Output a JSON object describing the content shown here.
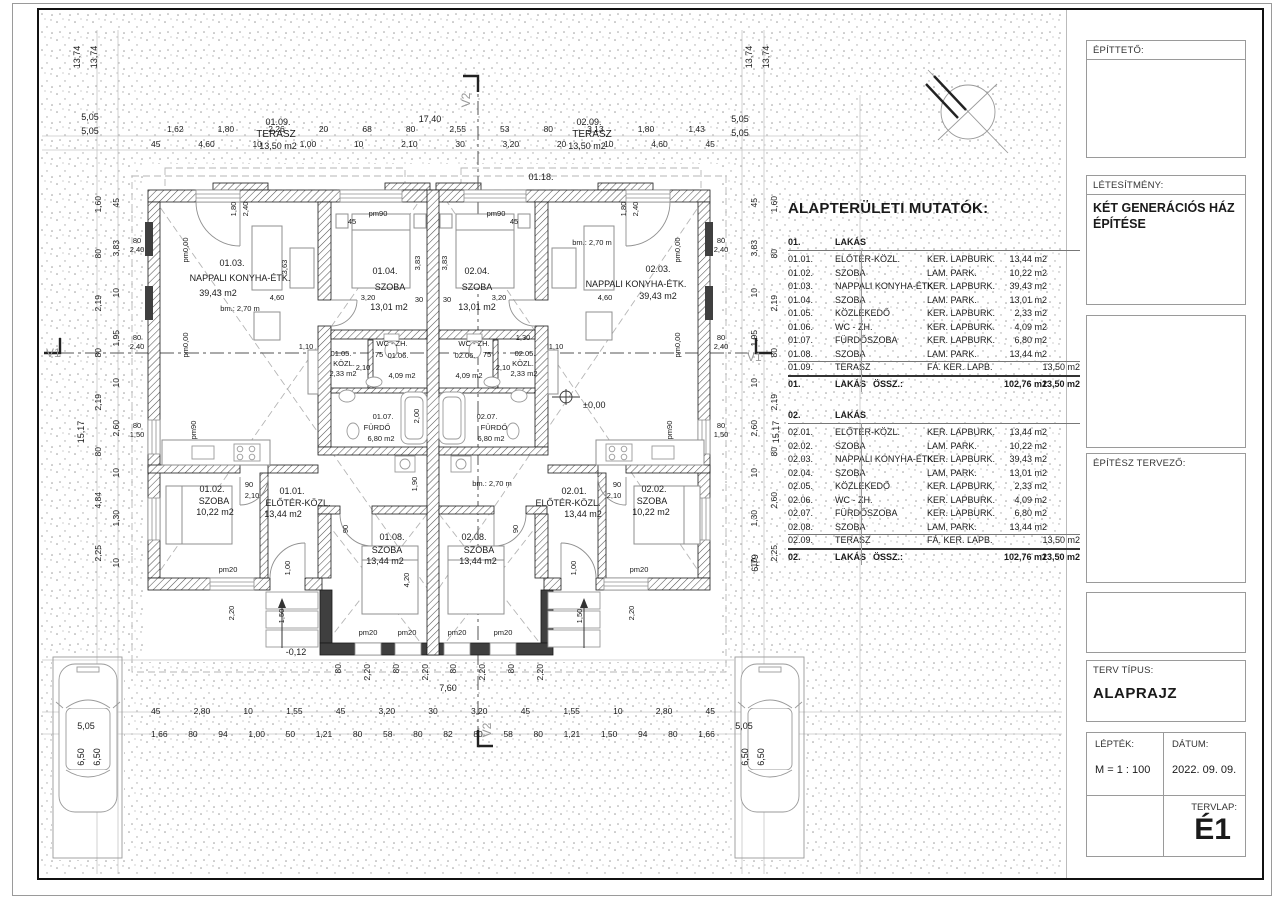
{
  "title_block": {
    "client_label": "ÉPÍTTETŐ:",
    "project_label": "LÉTESÍTMÉNY:",
    "project_value_line1": "KÉT GENERÁCIÓS HÁZ",
    "project_value_line2": "ÉPÍTÉSE",
    "architect_label": "ÉPÍTÉSZ TERVEZŐ:",
    "plan_type_label": "TERV TÍPUS:",
    "plan_type_value": "ALAPRAJZ",
    "scale_label": "LÉPTÉK:",
    "scale_value": "M = 1 : 100",
    "date_label": "DÁTUM:",
    "date_value": "2022. 09. 09.",
    "sheet_label": "TERVLAP:",
    "sheet_value": "É1"
  },
  "area_table": {
    "title": "ALAPTERÜLETI MUTATÓK:",
    "flats": [
      {
        "code": "01.",
        "name": "LAKÁS",
        "rows": [
          [
            "01.01.",
            "ELŐTÉR-KÖZL.",
            "KER. LAPBURK.",
            "13,44 m2",
            ""
          ],
          [
            "01.02.",
            "SZOBA",
            "LAM. PARK.",
            "10,22 m2",
            ""
          ],
          [
            "01.03.",
            "NAPPALI KONYHA-ÉTK.",
            "KER. LAPBURK.",
            "39,43 m2",
            ""
          ],
          [
            "01.04.",
            "SZOBA",
            "LAM. PARK.",
            "13,01 m2",
            ""
          ],
          [
            "01.05.",
            "KÖZLEKEDŐ",
            "KER. LAPBURK.",
            "2,33 m2",
            ""
          ],
          [
            "01.06.",
            "WC - ZH.",
            "KER. LAPBURK.",
            "4,09 m2",
            ""
          ],
          [
            "01.07.",
            "FÜRDŐSZOBA",
            "KER. LAPBURK.",
            "6,80 m2",
            ""
          ],
          [
            "01.08.",
            "SZOBA",
            "LAM. PARK.",
            "13,44 m2",
            ""
          ],
          [
            "01.09.",
            "TERASZ",
            "FÁ. KER. LAPB.",
            "",
            "13,50 m2"
          ]
        ],
        "total": [
          "01.",
          "LAKÁS",
          "ÖSSZ.:",
          "102,76 m2",
          "13,50 m2"
        ]
      },
      {
        "code": "02.",
        "name": "LAKÁS",
        "rows": [
          [
            "02.01.",
            "ELŐTÉR-KÖZL.",
            "KER. LAPBURK.",
            "13,44 m2",
            ""
          ],
          [
            "02.02.",
            "SZOBA",
            "LAM. PARK.",
            "10,22 m2",
            ""
          ],
          [
            "02.03.",
            "NAPPALI KONYHA-ÉTK.",
            "KER. LAPBURK.",
            "39,43 m2",
            ""
          ],
          [
            "02.04.",
            "SZOBA",
            "LAM. PARK.",
            "13,01 m2",
            ""
          ],
          [
            "02.05.",
            "KÖZLEKEDŐ",
            "KER. LAPBURK.",
            "2,33 m2",
            ""
          ],
          [
            "02.06.",
            "WC - ZH.",
            "KER. LAPBURK.",
            "4,09 m2",
            ""
          ],
          [
            "02.07.",
            "FÜRDŐSZOBA",
            "KER. LAPBURK.",
            "6,80 m2",
            ""
          ],
          [
            "02.08.",
            "SZOBA",
            "LAM. PARK.",
            "13,44 m2",
            ""
          ],
          [
            "02.09.",
            "TERASZ",
            "FÁ. KER. LAPB.",
            "",
            "13,50 m2"
          ]
        ],
        "total": [
          "02.",
          "LAKÁS",
          "ÖSSZ.:",
          "102,76 m2",
          "13,50 m2"
        ]
      }
    ]
  },
  "plan": {
    "rooms": [
      {
        "num": "01.01.",
        "name": "ELŐTÉR-KÖZL.",
        "area": "13,44 m2"
      },
      {
        "num": "01.02.",
        "name": "SZOBA",
        "area": "10,22 m2"
      },
      {
        "num": "01.03.",
        "name": "NAPPALI KONYHA-ÉTK.",
        "area": "39,43 m2"
      },
      {
        "num": "01.04.",
        "name": "SZOBA",
        "area": "13,01 m2"
      },
      {
        "num": "01.05.",
        "name": "KÖZL.",
        "area": "2,33 m2"
      },
      {
        "num": "01.06.",
        "name": "WC - ZH.",
        "area": "4,09 m2"
      },
      {
        "num": "01.07.",
        "name": "FÜRDŐ",
        "area": "6,80 m2"
      },
      {
        "num": "01.08.",
        "name": "SZOBA",
        "area": "13,44 m2"
      },
      {
        "num": "01.09.",
        "name": "TERASZ",
        "area": "13,50 m2"
      },
      {
        "num": "02.01.",
        "name": "ELŐTÉR-KÖZL.",
        "area": "13,44 m2"
      },
      {
        "num": "02.02.",
        "name": "SZOBA",
        "area": "10,22 m2"
      },
      {
        "num": "02.03.",
        "name": "NAPPALI KONYHA-ÉTK.",
        "area": "39,43 m2"
      },
      {
        "num": "02.04.",
        "name": "SZOBA",
        "area": "13,01 m2"
      },
      {
        "num": "02.05.",
        "name": "KÖZL.",
        "area": "2,33 m2"
      },
      {
        "num": "02.06.",
        "name": "WC - ZH.",
        "area": "4,09 m2"
      },
      {
        "num": "02.07.",
        "name": "FÜRDŐ",
        "area": "6,80 m2"
      },
      {
        "num": "02.08.",
        "name": "SZOBA",
        "area": "13,44 m2"
      },
      {
        "num": "02.09.",
        "name": "TERASZ",
        "area": "13,50 m2"
      }
    ],
    "dims": {
      "top1": [
        "1,62",
        "1,80",
        "2,26",
        "20",
        "68",
        "80",
        "2,55",
        "53",
        "80",
        "3,13",
        "1,80",
        "1,43"
      ],
      "top2": [
        "45",
        "4,60",
        "10",
        "1,00",
        "10",
        "2,10",
        "30",
        "3,20",
        "20",
        "10",
        "4,60",
        "45"
      ],
      "bottom1": [
        "45",
        "2,80",
        "10",
        "1,55",
        "45",
        "3,20",
        "30",
        "3,20",
        "45",
        "1,55",
        "10",
        "2,80",
        "45"
      ],
      "bottom2": [
        "1,66",
        "80",
        "94",
        "1,00",
        "50",
        "1,21",
        "80",
        "58",
        "80",
        "82",
        "80",
        "58",
        "80",
        "1,21",
        "1,50",
        "94",
        "80",
        "1,66"
      ],
      "left_a": [
        "1,60",
        "80",
        "2,19",
        "80",
        "2,19",
        "80",
        "4,84",
        "2,25"
      ],
      "left_b": [
        "45",
        "3,83",
        "10",
        "1,95",
        "10",
        "2,60",
        "10",
        "1,30",
        "10"
      ],
      "right_a": [
        "1,60",
        "80",
        "2,19",
        "80",
        "2,19",
        "80",
        "2,60",
        "2,25"
      ],
      "right_b": [
        "45",
        "3,83",
        "10",
        "1,95",
        "10",
        "2,60",
        "10",
        "1,30",
        "10"
      ],
      "win_bottom": [
        "80",
        "2,20",
        "80",
        "2,20",
        "80",
        "2,20",
        "80",
        "2,20"
      ]
    },
    "misc": {
      "v1": "V1",
      "v2": "V2",
      "d1740": "17,40",
      "d760": "7,60",
      "d505": "5,05",
      "d1374": "13,74",
      "d650": "6,50",
      "d1517": "15,17",
      "d679": "6,79",
      "lvl0": "±0,00",
      "lvlm12": "-0,12",
      "slab": "01.18.",
      "bm": "bm.: 2,70 m",
      "pm000": "pm0,00",
      "pm90": "pm90",
      "pm20": "pm20",
      "s80": "80",
      "s240": "2,40",
      "s150": "1,50",
      "s45": "45",
      "s320": "3,20",
      "s460": "4,60",
      "s180": "1,80",
      "s363": "3,63",
      "s383": "3,83",
      "s30": "30",
      "s210": "2,10",
      "s75": "75",
      "s90": "90",
      "s200": "2,00",
      "s420": "4,20",
      "s190": "1,90",
      "s110": "1,10",
      "s130": "1,30",
      "s100": "1,00",
      "s220": "2,20"
    }
  }
}
